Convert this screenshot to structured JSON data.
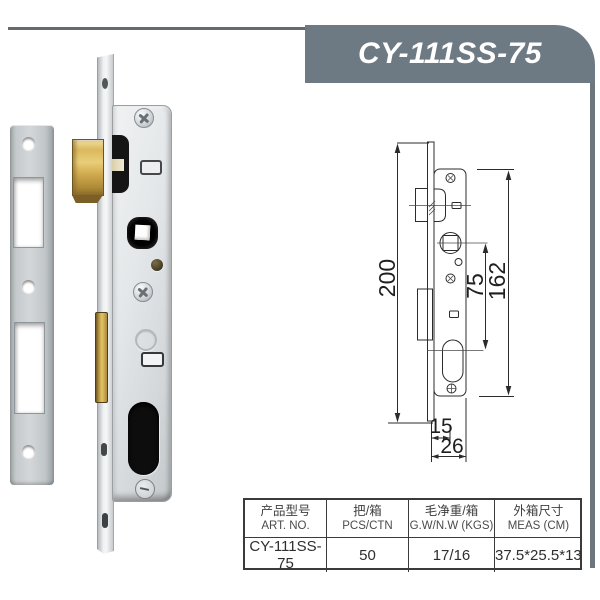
{
  "header": {
    "title": "CY-111SS-75"
  },
  "drawing": {
    "dims": {
      "overall_height": "200",
      "case_height": "162",
      "center_distance": "75",
      "backset": "15",
      "case_depth": "26"
    }
  },
  "spec_table": {
    "columns": [
      {
        "zh": "产品型号",
        "en": "ART. NO."
      },
      {
        "zh": "把/箱",
        "en": "PCS/CTN"
      },
      {
        "zh": "毛净重/箱",
        "en": "G.W/N.W (KGS)"
      },
      {
        "zh": "外箱尺寸",
        "en": "MEAS (CM)"
      }
    ],
    "row": {
      "art_no": "CY-111SS-75",
      "pcs_ctn": "50",
      "gw_nw": "17/16",
      "meas": "37.5*25.5*13"
    }
  },
  "colors": {
    "banner": "#6e7a83",
    "frame": "#6e767d",
    "brass": "#d7b257",
    "table_border": "#3b3b3b"
  }
}
